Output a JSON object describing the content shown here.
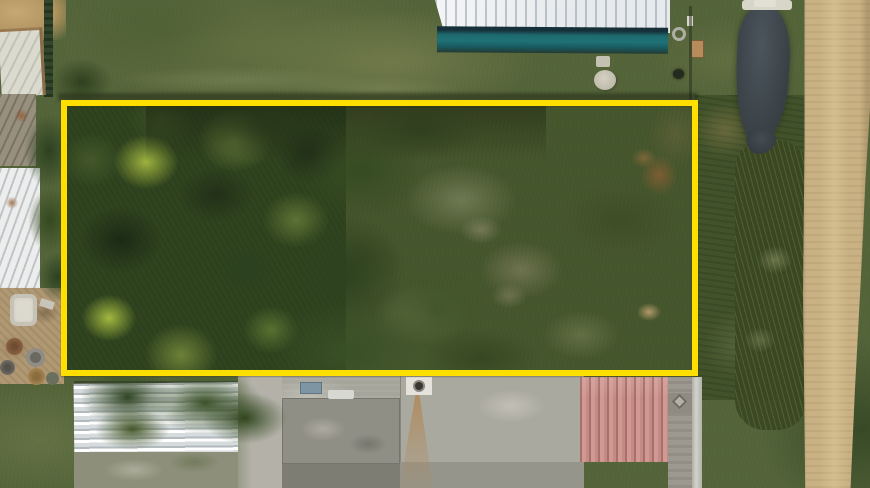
{
  "scene": {
    "type": "aerial-drone-photograph",
    "subject": "Overhead drone photo of a vacant, partly wooded grass parcel outlined with a yellow property-boundary annotation",
    "visible_text": "none",
    "orientation": "top-down (nadir) view"
  },
  "annotation": {
    "shape": "rectangle",
    "purpose": "property-boundary-highlight",
    "stroke_color": "#ffdf00",
    "stroke_width_px": 6,
    "x": 61,
    "y": 100,
    "width": 637,
    "height": 276
  },
  "palette": {
    "boundary_yellow": "#ffdf00",
    "lawn_base": "#55653a",
    "meadow": "#47572d",
    "tree_dark": "#1c2a15",
    "tree_mid": "#3c5026",
    "tree_light": "#6d8138",
    "tree_lime": "#9db23e",
    "dirt_road": "#c9b183",
    "pond_water": "#3e464b",
    "metal_roof_white": "#e7eaec",
    "roof_teal_edge": "#1f7276",
    "concrete_gray": "#a6a59c",
    "roof_pink": "#c28c86",
    "corrugated_white": "#e3e6e7",
    "rust_streak": "#b08a5a",
    "bare_dirt": "#b09873"
  },
  "regions": [
    {
      "name": "boundary-overlay",
      "description": "bright yellow rectangle outlining the parcel"
    },
    {
      "name": "wooded-canopy",
      "description": "dense tree canopy filling the left half of the parcel"
    },
    {
      "name": "meadow",
      "description": "overgrown grass meadow in right half of parcel with brown and sage patches"
    },
    {
      "name": "top-lawn",
      "description": "mowed olive-green lawn above the parcel"
    },
    {
      "name": "metal-building",
      "description": "white metal roof with teal lower edge at top center"
    },
    {
      "name": "pond",
      "description": "small dark pond at upper right"
    },
    {
      "name": "dirt-road",
      "description": "tan gravel road running along the right edge"
    },
    {
      "name": "roadside-scrub",
      "description": "weedy scrub and tall grass strip between parcel and road"
    },
    {
      "name": "left-sheds",
      "description": "white shed roofs and tarp structures along the left edge"
    },
    {
      "name": "junk-yard",
      "description": "bare dirt with barrels, tub and debris at lower left"
    },
    {
      "name": "bottom-buildings",
      "description": "gray concrete roofs, a white corrugated roof and a pink metal roof below the parcel"
    },
    {
      "name": "vent-chimney",
      "description": "white vent pad with dark flue and rust streak on the concrete roof"
    },
    {
      "name": "septic-lid",
      "description": "round pale concrete lid in the lawn near the building"
    }
  ]
}
